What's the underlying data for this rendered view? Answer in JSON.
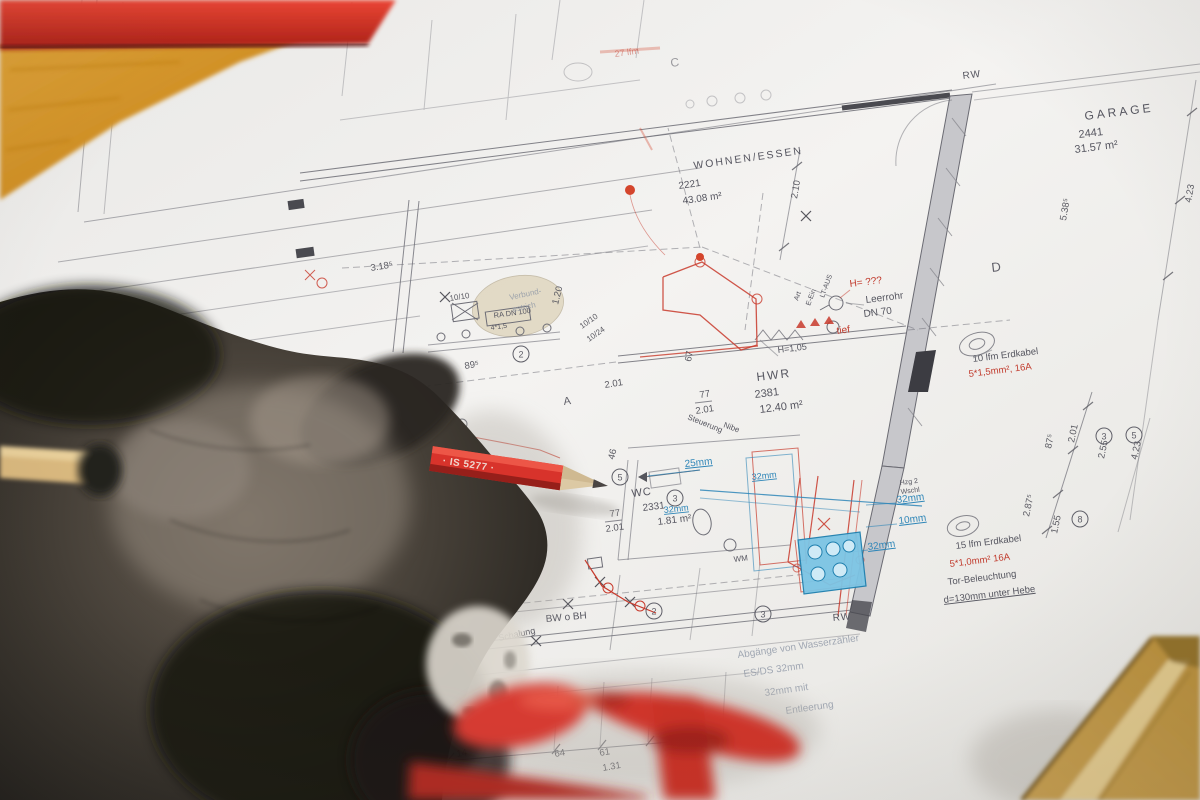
{
  "scene": {
    "type": "photograph",
    "subject": "Gloved hand with red pencil pointing at a German architectural installation floor plan",
    "objects": [
      "work-glove",
      "red-pencil",
      "wood-stick",
      "red-clamp-tool",
      "wooden-square",
      "wooden-block",
      "red-tool-edge",
      "floor-plan-sheet"
    ]
  },
  "objects": {
    "pencil": {
      "color": "#d8332b",
      "text": "· IS 5277 ·"
    }
  },
  "plan": {
    "colors": {
      "ink": "#565660",
      "red": "#c13a2c",
      "blue": "#2f86b8",
      "paper": "#f0efed"
    },
    "texts": {
      "room_labels": [
        {
          "t": "GARAGE",
          "x": 1085,
          "y": 120,
          "r": -7,
          "s": 12,
          "sp": 3,
          "n": "room-garage-name"
        },
        {
          "t": "2441",
          "x": 1079,
          "y": 138,
          "r": -7,
          "s": 11,
          "n": "room-garage-number"
        },
        {
          "t": "31.57 m²",
          "x": 1075,
          "y": 153,
          "r": -7,
          "s": 11,
          "n": "room-garage-area"
        },
        {
          "t": "WOHNEN/ESSEN",
          "x": 694,
          "y": 169,
          "r": -8,
          "s": 10.5,
          "sp": 2,
          "n": "room-wohnen-name"
        },
        {
          "t": "2221",
          "x": 679,
          "y": 189,
          "r": -8,
          "s": 10,
          "n": "room-wohnen-number"
        },
        {
          "t": "43.08 m²",
          "x": 683,
          "y": 204,
          "r": -8,
          "s": 10,
          "n": "room-wohnen-area"
        },
        {
          "t": "HWR",
          "x": 757,
          "y": 381,
          "r": -7,
          "s": 12,
          "sp": 2,
          "n": "room-hwr-name"
        },
        {
          "t": "2381",
          "x": 755,
          "y": 398,
          "r": -7,
          "s": 11,
          "n": "room-hwr-number"
        },
        {
          "t": "12.40 m²",
          "x": 760,
          "y": 413,
          "r": -7,
          "s": 11,
          "n": "room-hwr-area"
        },
        {
          "t": "WC",
          "x": 632,
          "y": 497,
          "r": -7,
          "s": 11,
          "sp": 1,
          "n": "room-wc-name"
        },
        {
          "t": "2331",
          "x": 643,
          "y": 511,
          "r": -7,
          "s": 10,
          "n": "room-wc-number"
        },
        {
          "t": "1.81 m²",
          "x": 658,
          "y": 525,
          "r": -7,
          "s": 10,
          "n": "room-wc-area"
        }
      ],
      "dimensions": [
        {
          "t": "2.10",
          "x": 797,
          "y": 199,
          "r": -80
        },
        {
          "t": "5.38⁵",
          "x": 1066,
          "y": 221,
          "r": -80
        },
        {
          "t": "4.23",
          "x": 1191,
          "y": 203,
          "r": -80
        },
        {
          "t": "87⁵",
          "x": 1051,
          "y": 449,
          "r": -78
        },
        {
          "t": "2.01",
          "x": 1074,
          "y": 443,
          "r": -78
        },
        {
          "t": "2.55",
          "x": 1104,
          "y": 459,
          "r": -78
        },
        {
          "t": "4.23",
          "x": 1137,
          "y": 460,
          "r": -78
        },
        {
          "t": "2.87⁵",
          "x": 1029,
          "y": 517,
          "r": -78
        },
        {
          "t": "1.55",
          "x": 1057,
          "y": 534,
          "r": -78
        },
        {
          "t": "3.18⁵",
          "x": 371,
          "y": 271,
          "r": -9
        },
        {
          "t": "89⁵",
          "x": 465,
          "y": 369,
          "r": -9
        },
        {
          "t": "2.01",
          "x": 605,
          "y": 388,
          "r": -9
        },
        {
          "t": "77",
          "x": 700,
          "y": 398,
          "r": -9
        },
        {
          "t": "2.01",
          "x": 696,
          "y": 414,
          "r": -9
        },
        {
          "t": "67",
          "x": 691,
          "y": 362,
          "r": -80
        },
        {
          "t": "77",
          "x": 610,
          "y": 517,
          "r": -8
        },
        {
          "t": "2.01",
          "x": 606,
          "y": 532,
          "r": -8
        },
        {
          "t": "1.20",
          "x": 558,
          "y": 305,
          "r": -76
        },
        {
          "t": "46",
          "x": 614,
          "y": 460,
          "r": -76
        },
        {
          "t": "2.24⁵",
          "x": 416,
          "y": 770,
          "r": -10
        },
        {
          "t": "14",
          "x": 457,
          "y": 757,
          "r": -10
        },
        {
          "t": "64",
          "x": 555,
          "y": 757,
          "r": -10
        },
        {
          "t": "61",
          "x": 600,
          "y": 756,
          "r": -10
        },
        {
          "t": "1.31",
          "x": 603,
          "y": 771,
          "r": -10
        },
        {
          "t": "10/10",
          "x": 450,
          "y": 301,
          "r": -9,
          "s": 8
        },
        {
          "t": "10/10",
          "x": 582,
          "y": 329,
          "r": -35,
          "s": 8
        },
        {
          "t": "10/24",
          "x": 589,
          "y": 342,
          "r": -35,
          "s": 8
        }
      ],
      "annotations": [
        {
          "t": "Leerrohr",
          "x": 866,
          "y": 303,
          "r": -7,
          "s": 10
        },
        {
          "t": "DN 70",
          "x": 864,
          "y": 317,
          "r": -7,
          "s": 10
        },
        {
          "t": "H=1,05",
          "x": 778,
          "y": 353,
          "r": -7,
          "s": 9
        },
        {
          "t": "10 lfm Erdkabel",
          "x": 973,
          "y": 362,
          "r": -7,
          "s": 9.5
        },
        {
          "t": "15 lfm Erdkabel",
          "x": 956,
          "y": 549,
          "r": -7,
          "s": 9.5
        },
        {
          "t": "Tor-Beleuchtung",
          "x": 948,
          "y": 585,
          "r": -7,
          "s": 9.5
        },
        {
          "t": "d=130mm unter Hebe",
          "x": 944,
          "y": 603,
          "r": -7,
          "s": 9.5,
          "u": 1
        },
        {
          "t": "RA DN 100",
          "x": 494,
          "y": 318,
          "r": -8,
          "s": 7.5
        },
        {
          "t": "4*1,5",
          "x": 491,
          "y": 330,
          "r": -8,
          "s": 7
        },
        {
          "t": "BW o BH",
          "x": 546,
          "y": 622,
          "r": -5,
          "s": 10
        },
        {
          "t": "Schalung",
          "x": 499,
          "y": 641,
          "r": -12,
          "s": 9
        },
        {
          "t": "Steuerung",
          "x": 687,
          "y": 419,
          "r": 22,
          "s": 8
        },
        {
          "t": "Nibe",
          "x": 723,
          "y": 427,
          "r": 20,
          "s": 8
        },
        {
          "t": "Art",
          "x": 798,
          "y": 301,
          "r": -70,
          "s": 7
        },
        {
          "t": "E-Ein",
          "x": 810,
          "y": 306,
          "r": -70,
          "s": 7
        },
        {
          "t": "LT-AUS",
          "x": 824,
          "y": 298,
          "r": -70,
          "s": 7
        },
        {
          "t": "Hzg 2",
          "x": 900,
          "y": 485,
          "r": -7,
          "s": 7
        },
        {
          "t": "Wschl",
          "x": 901,
          "y": 494,
          "r": -7,
          "s": 7
        },
        {
          "t": "WM",
          "x": 734,
          "y": 562,
          "r": -7,
          "s": 8
        },
        {
          "t": "RW",
          "x": 963,
          "y": 79,
          "r": -7,
          "s": 10,
          "sp": 1
        },
        {
          "t": "RW",
          "x": 833,
          "y": 621,
          "r": -5,
          "s": 10,
          "sp": 1
        }
      ],
      "annotations_red": [
        {
          "t": "H= ???",
          "x": 850,
          "y": 287,
          "r": -7,
          "s": 10
        },
        {
          "t": "tief",
          "x": 837,
          "y": 334,
          "r": -7,
          "s": 10
        },
        {
          "t": "5*1,5mm², 16A",
          "x": 969,
          "y": 377,
          "r": -7,
          "s": 9.5
        },
        {
          "t": "5*1,0mm² 16A",
          "x": 950,
          "y": 567,
          "r": -7,
          "s": 9.5
        },
        {
          "t": "27 lfm",
          "x": 615,
          "y": 57,
          "r": -8,
          "s": 9,
          "o": 0.5
        }
      ],
      "annotations_blue": [
        {
          "t": "25mm",
          "x": 685,
          "y": 467,
          "r": -6,
          "s": 10,
          "u": 1
        },
        {
          "t": "32mm",
          "x": 752,
          "y": 480,
          "r": -6,
          "s": 9,
          "u": 1
        },
        {
          "t": "32mm",
          "x": 664,
          "y": 513,
          "r": -6,
          "s": 9,
          "u": 1
        },
        {
          "t": "32mm",
          "x": 897,
          "y": 503,
          "r": -7,
          "s": 10,
          "u": 1
        },
        {
          "t": "10mm",
          "x": 899,
          "y": 524,
          "r": -7,
          "s": 10,
          "u": 1
        },
        {
          "t": "32mm",
          "x": 868,
          "y": 550,
          "r": -7,
          "s": 10,
          "u": 1
        }
      ],
      "annotations_faded": [
        {
          "t": "Abgänge von Wasserzähler",
          "x": 738,
          "y": 658,
          "r": -8,
          "s": 10
        },
        {
          "t": "ES/DS 32mm",
          "x": 744,
          "y": 677,
          "r": -8,
          "s": 10
        },
        {
          "t": "32mm mit",
          "x": 765,
          "y": 696,
          "r": -8,
          "s": 10
        },
        {
          "t": "Entleerung",
          "x": 786,
          "y": 714,
          "r": -8,
          "s": 10
        },
        {
          "t": "Verbund-",
          "x": 510,
          "y": 300,
          "r": -12,
          "s": 8
        },
        {
          "t": "estrich",
          "x": 513,
          "y": 312,
          "r": -12,
          "s": 8
        }
      ],
      "grid_letters": [
        {
          "t": "C",
          "x": 671,
          "y": 67,
          "r": -8,
          "s": 12,
          "o": 0.6
        },
        {
          "t": "D",
          "x": 992,
          "y": 272,
          "r": -7,
          "s": 13
        },
        {
          "t": "A",
          "x": 564,
          "y": 405,
          "r": -8,
          "s": 11
        },
        {
          "t": "B",
          "x": 12,
          "y": 328,
          "r": 0,
          "s": 10,
          "o": 0.7
        }
      ]
    },
    "circled_numbers": [
      {
        "n": "1",
        "x": 436,
        "y": 607
      },
      {
        "n": "2",
        "x": 521,
        "y": 354
      },
      {
        "n": "2",
        "x": 654,
        "y": 611
      },
      {
        "n": "3",
        "x": 675,
        "y": 498
      },
      {
        "n": "3",
        "x": 763,
        "y": 614
      },
      {
        "n": "3",
        "x": 1104,
        "y": 436
      },
      {
        "n": "5",
        "x": 1134,
        "y": 435
      },
      {
        "n": "5",
        "x": 620,
        "y": 477
      },
      {
        "n": "8",
        "x": 1080,
        "y": 519
      }
    ]
  }
}
